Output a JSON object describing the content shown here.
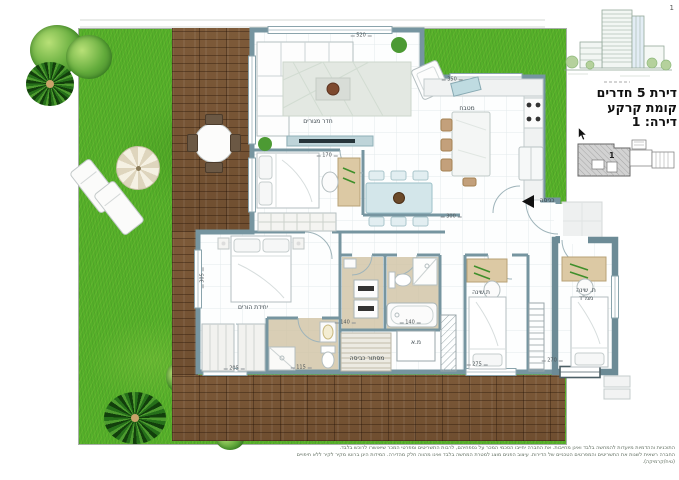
{
  "page": {
    "number": "1"
  },
  "info_panel": {
    "title_rooms": "דירת 5 חדרים",
    "title_floor": "קומת קרקע",
    "title_unit": "דירה: 1",
    "keyplan_unit_number": "1"
  },
  "plan": {
    "rooms": {
      "living_room": "חדר מגורים",
      "kitchen": "מטבח",
      "entrance": "כניסה",
      "master_suite": "יחידת הורים",
      "bedroom2": "ת.שינה",
      "mamad_line1": "ת. שינה",
      "mamad_line2": "ממ\"ד",
      "laundry_screen": "מסתור כביסה",
      "ac_closet": "מ.א"
    },
    "dimensions": {
      "living_width": "520",
      "kitchen_width": "350",
      "dining_width": "300",
      "bedroom1_width": "170",
      "master_window": "305",
      "closet_width": "205",
      "ensuite_width": "115",
      "bath1_width": "140",
      "bath2_width": "140",
      "bedroom2_width": "275",
      "mamad_width": "270"
    }
  },
  "footer": {
    "disclaimer_line1": "התוכניות וההדמיות מיועדות להמחשה בלבד ואינן מחייבות. את החברה יחייבו הסכמי המכר על נספחיהם, לרבות התשריטים ומפרטי המכר שיאושרו לרוכש בלבד.",
    "disclaimer_line2": "החברה רשאית לשנות את התשריטים והמפרטים הטכניים של הדירות. עיצוב הפנים מוצג למטרת המחשה בלבד ואינו מהווה חלק מהדירה. המידות הינן ברוטו מקיר לקיר ללא חיפויים (טיח/קרמיקה)."
  },
  "colors": {
    "wall": "#7695a0",
    "grass": "#55b02a",
    "deck_wood": "#7a5637",
    "bath_floor": "#cfc2a2"
  }
}
